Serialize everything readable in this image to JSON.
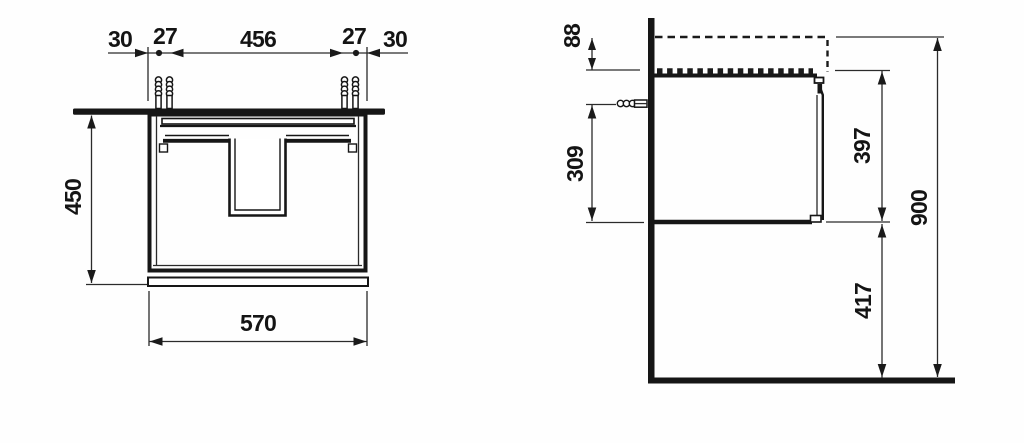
{
  "drawing": {
    "front_view": {
      "top_dimensions": {
        "left_edge": "30",
        "left_pair": "27",
        "center_span": "456",
        "right_pair": "27",
        "right_edge": "30"
      },
      "height": "450",
      "width": "570"
    },
    "side_view": {
      "basin_above_cabinet": "88",
      "anchor_to_bottom": "309",
      "cabinet_height": "397",
      "floor_clearance": "417",
      "total_height": "900"
    }
  }
}
